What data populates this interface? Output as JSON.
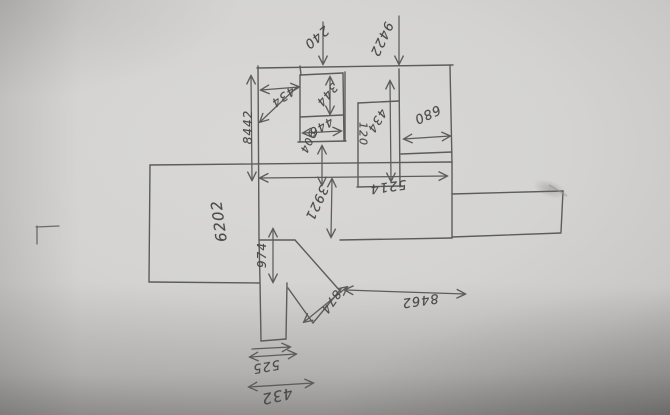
{
  "sketch": {
    "kind": "hand-drawn dimension sketch (photographed upside down)",
    "pencil_color": "#5c5c5c",
    "paper_color": "#d4d3d1",
    "labels": [
      {
        "text": "240",
        "x": 316,
        "y": 37,
        "angle": 140,
        "size": 13
      },
      {
        "text": "9422",
        "x": 381,
        "y": 39,
        "angle": 115,
        "size": 13
      },
      {
        "text": "434",
        "x": 283,
        "y": 97,
        "angle": 145,
        "size": 12
      },
      {
        "text": "8442",
        "x": 248,
        "y": 127,
        "angle": 270,
        "size": 12
      },
      {
        "text": "344",
        "x": 327,
        "y": 95,
        "angle": 130,
        "size": 12
      },
      {
        "text": "446",
        "x": 321,
        "y": 127,
        "angle": 150,
        "size": 12
      },
      {
        "text": "434",
        "x": 377,
        "y": 121,
        "angle": 122,
        "size": 12
      },
      {
        "text": "120",
        "x": 363,
        "y": 134,
        "angle": 90,
        "size": 11
      },
      {
        "text": "680",
        "x": 427,
        "y": 114,
        "angle": 155,
        "size": 13
      },
      {
        "text": "904",
        "x": 308,
        "y": 142,
        "angle": 115,
        "size": 11
      },
      {
        "text": "6202",
        "x": 219,
        "y": 221,
        "angle": 262,
        "size": 15
      },
      {
        "text": "3921",
        "x": 316,
        "y": 203,
        "angle": 115,
        "size": 13
      },
      {
        "text": "5214",
        "x": 388,
        "y": 186,
        "angle": 172,
        "size": 13
      },
      {
        "text": "974",
        "x": 262,
        "y": 255,
        "angle": 270,
        "size": 12
      },
      {
        "text": "874",
        "x": 331,
        "y": 302,
        "angle": 125,
        "size": 12
      },
      {
        "text": "8462",
        "x": 420,
        "y": 300,
        "angle": 172,
        "size": 13
      },
      {
        "text": "525",
        "x": 266,
        "y": 366,
        "angle": 170,
        "size": 13
      },
      {
        "text": "432",
        "x": 277,
        "y": 396,
        "angle": 168,
        "size": 15
      }
    ]
  }
}
